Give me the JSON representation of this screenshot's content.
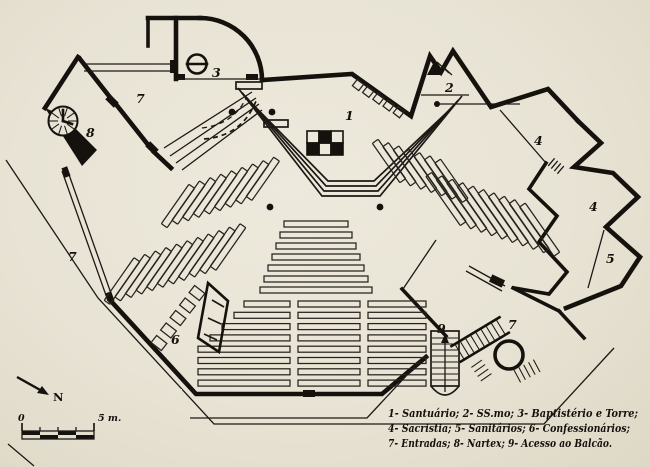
{
  "page": {
    "kind": "scanned church floor plan",
    "paper_color": "#e8e3d4",
    "ink_color": "#15120e"
  },
  "legend": {
    "lines": [
      "1- Santuário; 2- SS.mo; 3- Baptistério e Torre;",
      "4- Sacristia; 5- Sanitários; 6- Confessionários;",
      "7- Entradas; 8- Nartex; 9- Acesso ao Balcão."
    ]
  },
  "scale_bar": {
    "start_label": "0",
    "end_label": "5 m."
  },
  "north": {
    "label": "N"
  },
  "plan_labels": [
    {
      "n": "3",
      "x": 212,
      "y": 77,
      "room": "baptisterio-e-torre"
    },
    {
      "n": "7",
      "x": 136,
      "y": 103,
      "room": "entrada"
    },
    {
      "n": "8",
      "x": 86,
      "y": 137,
      "room": "nartex"
    },
    {
      "n": "1",
      "x": 345,
      "y": 120,
      "room": "santuario"
    },
    {
      "n": "2",
      "x": 445,
      "y": 92,
      "room": "ss-mo"
    },
    {
      "n": "4",
      "x": 534,
      "y": 145,
      "room": "sacristia"
    },
    {
      "n": "4",
      "x": 589,
      "y": 211,
      "room": "sacristia"
    },
    {
      "n": "5",
      "x": 606,
      "y": 263,
      "room": "sanitarios"
    },
    {
      "n": "7",
      "x": 68,
      "y": 261,
      "room": "entrada"
    },
    {
      "n": "6",
      "x": 171,
      "y": 344,
      "room": "confessionarios"
    },
    {
      "n": "9",
      "x": 437,
      "y": 333,
      "room": "acesso-ao-balcao"
    },
    {
      "n": "7",
      "x": 508,
      "y": 329,
      "room": "entrada"
    }
  ]
}
